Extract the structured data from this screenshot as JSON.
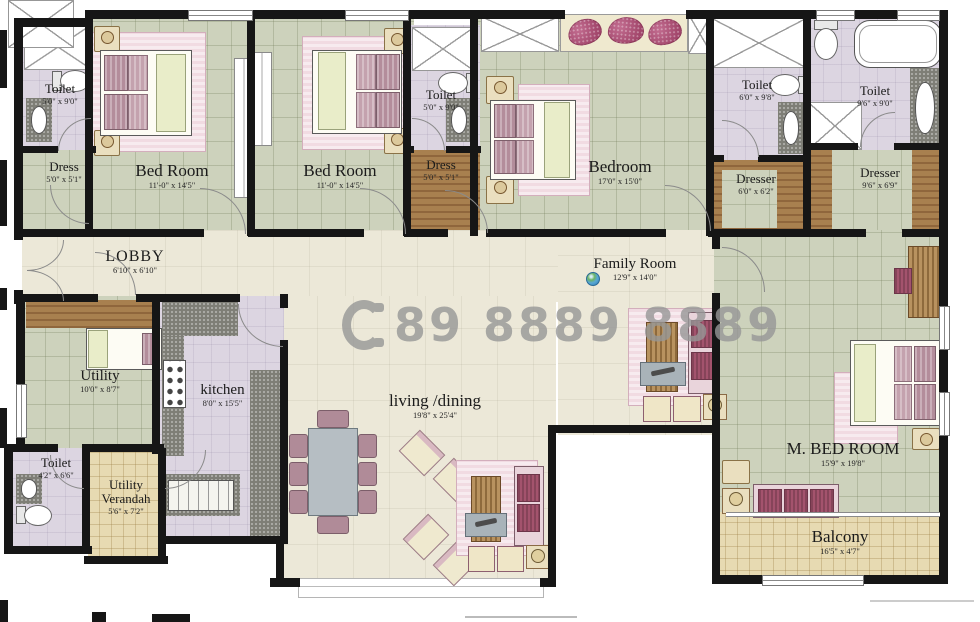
{
  "title": "Apartment Floor Plan",
  "watermark": {
    "icon": "phone-handset",
    "phone_number": "89 8889 8889"
  },
  "rooms": {
    "t1": {
      "name": "Toilet",
      "dim": "5'0\" x 9'0\""
    },
    "d1": {
      "name": "Dress",
      "dim": "5'0\" x 5'1\""
    },
    "br1": {
      "name": "Bed Room",
      "dim": "11'-0\" x 14'5\""
    },
    "br2": {
      "name": "Bed Room",
      "dim": "11'-0\" x 14'5\""
    },
    "t2": {
      "name": "Toilet",
      "dim": "5'0\" x 9'0\""
    },
    "d2": {
      "name": "Dress",
      "dim": "5'0\" x 5'1\""
    },
    "br3": {
      "name": "Bedroom",
      "dim": "17'0\" x 15'0\""
    },
    "t3": {
      "name": "Toilet",
      "dim": "6'0\" x 9'8\""
    },
    "t4": {
      "name": "Toilet",
      "dim": "9'6\" x 9'0\""
    },
    "dr1": {
      "name": "Dresser",
      "dim": "6'0\" x 6'2\""
    },
    "dr2": {
      "name": "Dresser",
      "dim": "9'6\" x 6'9\""
    },
    "lobby": {
      "name": "LOBBY",
      "dim": "6'10\" x 6'10\""
    },
    "family": {
      "name": "Family Room",
      "dim": "12'9\" x 14'0\""
    },
    "utility": {
      "name": "Utility",
      "dim": "10'0\" x 8'7\""
    },
    "kitchen": {
      "name": "kitchen",
      "dim": "8'0\" x 15'5\""
    },
    "t5": {
      "name": "Toilet",
      "dim": "4'2\" x 6'6\""
    },
    "verandah": {
      "name": "Utility Verandah",
      "dim": "5'6\" x 7'2\""
    },
    "living": {
      "name": "living /dining",
      "dim": "19'8\" x 25'4\""
    },
    "mbed": {
      "name": "M. BED ROOM",
      "dim": "15'9\" x 19'8\""
    },
    "balcony": {
      "name": "Balcony",
      "dim": "16'5\" x 4'7\""
    }
  },
  "colors": {
    "wall": "#161616",
    "tile_green": "#cdd2bc",
    "floor_cream": "#ece8d8",
    "toilet_lavender": "#dcd5e1",
    "wood": "#a8804f",
    "granite": "#7e7e76",
    "balcony_tan": "#e7dab2",
    "rug_pink": "#f1dbe2",
    "cushion_magenta": "#a3536d",
    "watermark_gray": "#979797"
  }
}
